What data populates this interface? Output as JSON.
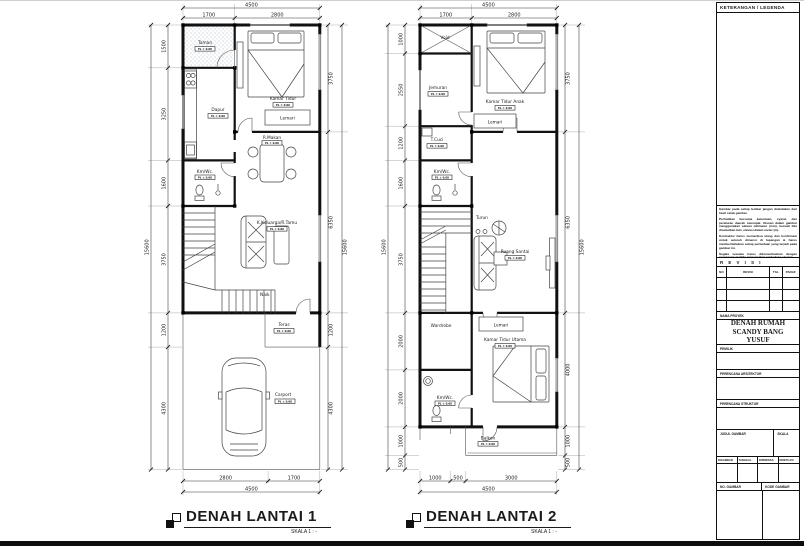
{
  "plan1": {
    "top_total": "4500",
    "dims_top": [
      "1700",
      "2800"
    ],
    "dims_left": [
      "1500",
      "3250",
      "1600",
      "3750",
      "1200",
      "4300"
    ],
    "left_total": "15600",
    "dims_right": [
      "3750",
      "6350",
      "1200",
      "4300"
    ],
    "right_total": "15600",
    "dims_bottom": [
      "2800",
      "1700"
    ],
    "bottom_total": "4500",
    "labels": {
      "taman": "Taman",
      "dapur": "Dapur",
      "kamar_tidur": "Kamar Tidur",
      "lemari": "Lemari",
      "r_makan": "R.Makan",
      "kmwc": "Km/Wc.",
      "keluarga": "K.Keluarga/R.Tamu",
      "naik": "Naik",
      "teras": "Teras",
      "carport": "Carport",
      "elev": "PL ± 0.00"
    }
  },
  "plan2": {
    "top_total": "4500",
    "dims_top": [
      "1700",
      "2800"
    ],
    "dims_left": [
      "1000",
      "2550",
      "1200",
      "1600",
      "3750",
      "2000",
      "2000",
      "1000",
      "500"
    ],
    "left_total": "15600",
    "dims_right": [
      "3750",
      "6350",
      "4000",
      "1000",
      "500"
    ],
    "right_total": "15600",
    "dims_bottom": [
      "1000",
      "500",
      "3000"
    ],
    "bottom_total": "4500",
    "labels": {
      "void": "Void",
      "jemuran": "Jemuran",
      "kt_anak": "Kamar Tidur Anak",
      "lemari": "Lemari",
      "tcuci": "T.Cuci",
      "kmwc": "Km/Wc.",
      "turun": "Turun",
      "santai": "Ruang Santai",
      "wardrobe": "Wardrobe",
      "lemari2": "Lemari",
      "kt_utama": "Kamar Tidur Utama",
      "kmwc2": "Km/Wc.",
      "balkon": "Balkon",
      "elev": "PL ± 0.00"
    }
  },
  "titles": [
    {
      "label": "DENAH LANTAI 1",
      "scale": "SKALA 1 : -"
    },
    {
      "label": "DENAH LANTAI 2",
      "scale": "SKALA 1 : -"
    }
  ],
  "titleblock": {
    "legend_header": "KETERANGAN / LEGENDA",
    "notes": [
      "Gambar pada setiap lembar jangan diskalakan dari hasil cetak gambar.",
      "Perhatikan bersama ketentuan, syarat, dan peraturan daerah setempat. Ukuran dalam gambar menggunakan satuan milimeter (mm), kecuali bila disebutkan lain, elevasi dalam meter (m).",
      "Kontraktor harus memeriksa ulang dan konfirmasi untuk seluruh dimensi di lapangan & harus memberitahukan setiap perbedaan yang terjadi pada gambar ini.",
      "Segala sesuatu harus dikonsultasikan dengan perencana apabila menemukan perbedaan ukuran."
    ],
    "revisi_header": "R E V I S I",
    "revisi_cols": [
      "NO",
      "REVISI",
      "TGL",
      "PARAF"
    ],
    "nama_proyek_label": "NAMA PROYEK",
    "nama_proyek": "DENAH RUMAH SCANDY BANG YUSUF",
    "pemilik_label": "PEMILIK",
    "arsitektur_label": "PERENCANA ARSITEKTUR",
    "struktur_label": "PERENCANA STRUKTUR",
    "judul_label": "JUDUL GAMBAR",
    "skala_label": "SKALA",
    "sign_cols": [
      "DIGAMBAR",
      "TANGGAL",
      "DIPERIKSA",
      "DISETUJUI"
    ],
    "no_gambar_label": "NO. GAMBAR",
    "kode_gambar_label": "KODE GAMBAR"
  }
}
